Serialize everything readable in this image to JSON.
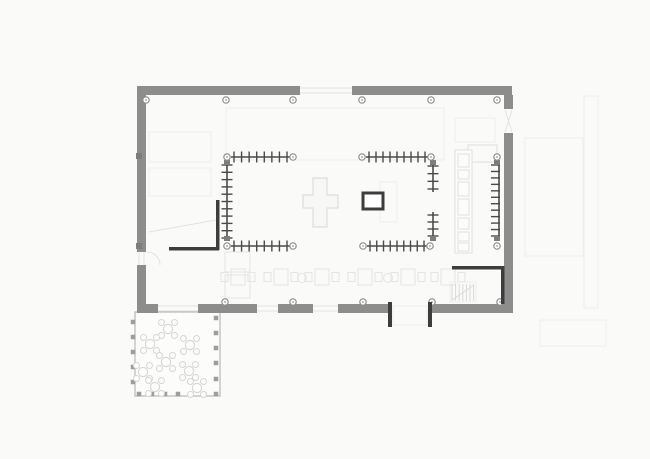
{
  "canvas": {
    "width": 650,
    "height": 459
  },
  "colors": {
    "background": "#fafaf9",
    "wall": "#8d8d8d",
    "wall_dark": "#3d3d3d",
    "table_line": "#4a4a4a",
    "column_stroke": "#8e8e8e",
    "column_fill": "#fdfdfd",
    "column_dot": "#9a9a9a",
    "block": "#7d7d7d",
    "ghost": "#eeeeec",
    "ghost_mid": "#e2e2e1",
    "kitchen": "#dfdfde",
    "stairs": "#d9d9d8",
    "terrace_frame": "#b8b8b8",
    "terrace_post": "#9d9d9d",
    "terrace_furniture": "#d6d6d5",
    "dining_faint": "#e4e4e3",
    "cross_stroke": "#dedddc",
    "cross_fill": "#f7f7f6",
    "stove_stroke": "#3d3d3d",
    "stove_fill": "#ffffff"
  },
  "plan": {
    "walls_outer": [
      [
        137,
        86,
        163,
        9
      ],
      [
        352,
        86,
        160,
        9
      ],
      [
        504,
        95,
        9,
        14
      ],
      [
        504,
        133,
        9,
        180
      ],
      [
        137,
        86,
        9,
        166
      ],
      [
        137,
        265,
        9,
        48
      ],
      [
        146,
        304,
        12,
        9
      ],
      [
        198,
        304,
        59,
        9
      ],
      [
        278,
        304,
        35,
        9
      ],
      [
        338,
        304,
        50,
        9
      ],
      [
        432,
        304,
        81,
        9
      ]
    ],
    "walls_dark": [
      [
        216,
        200,
        3.5,
        50
      ],
      [
        169,
        247,
        50,
        3.5
      ],
      [
        452,
        266,
        52,
        3.5
      ],
      [
        501,
        266,
        3.5,
        38
      ],
      [
        388,
        302,
        4,
        25
      ],
      [
        428,
        302,
        4,
        25
      ]
    ],
    "columns": {
      "radius": 3.2,
      "points": [
        [
          146,
          100
        ],
        [
          226,
          100
        ],
        [
          293,
          100
        ],
        [
          362,
          100
        ],
        [
          431,
          100
        ],
        [
          497,
          100
        ],
        [
          227,
          157
        ],
        [
          293,
          157
        ],
        [
          362,
          157
        ],
        [
          431,
          157
        ],
        [
          497,
          157
        ],
        [
          227,
          246
        ],
        [
          293,
          246
        ],
        [
          363,
          246
        ],
        [
          430,
          246
        ],
        [
          497,
          246
        ],
        [
          225,
          302
        ],
        [
          293,
          302
        ],
        [
          363,
          302
        ],
        [
          432,
          302
        ],
        [
          500,
          302
        ]
      ]
    },
    "blocks": [
      [
        136,
        153,
        6,
        6
      ],
      [
        136,
        243,
        6,
        6
      ],
      [
        224,
        160,
        6,
        5
      ],
      [
        224,
        236,
        6,
        5
      ],
      [
        430,
        160,
        6,
        5
      ],
      [
        430,
        236,
        6,
        5
      ],
      [
        494,
        160,
        6,
        5
      ],
      [
        494,
        236,
        6,
        5
      ]
    ],
    "long_tables": [
      {
        "o": "h",
        "x": 231,
        "y": 157,
        "len": 59,
        "ticks": 8,
        "side": "both"
      },
      {
        "o": "h",
        "x": 366,
        "y": 157,
        "len": 62,
        "ticks": 9,
        "side": "both"
      },
      {
        "o": "h",
        "x": 231,
        "y": 246,
        "len": 59,
        "ticks": 8,
        "side": "both"
      },
      {
        "o": "h",
        "x": 367,
        "y": 246,
        "len": 60,
        "ticks": 9,
        "side": "both"
      },
      {
        "o": "v",
        "x": 227,
        "y": 162,
        "len": 79,
        "ticks": 11,
        "side": "both"
      },
      {
        "o": "v",
        "x": 433,
        "y": 163,
        "len": 29,
        "ticks": 4,
        "side": "both"
      },
      {
        "o": "v",
        "x": 433,
        "y": 212,
        "len": 27,
        "ticks": 4,
        "side": "both"
      },
      {
        "o": "v",
        "x": 499,
        "y": 162,
        "len": 77,
        "ticks": 12,
        "side": "left"
      }
    ],
    "cross_path": "M313 178 H327 V195 H338 V208 H327 V227 H313 V208 H303 V195 H313 Z",
    "stove": [
      363,
      193,
      20,
      16
    ],
    "kitchen": {
      "counter": [
        455,
        150,
        17,
        103
      ],
      "top_strip": [
        468,
        145,
        29,
        17
      ],
      "items": [
        [
          458,
          154,
          11,
          13
        ],
        [
          458,
          170,
          11,
          9
        ],
        [
          458,
          182,
          11,
          14
        ],
        [
          458,
          199,
          11,
          16
        ],
        [
          458,
          218,
          11,
          11
        ],
        [
          458,
          232,
          11,
          9
        ],
        [
          458,
          243,
          11,
          8
        ]
      ]
    },
    "stairs": {
      "x0": 452,
      "treads": 7,
      "step": 3.6,
      "y1": 284,
      "y2": 301,
      "diag": [
        452,
        300,
        474,
        285
      ],
      "box": [
        450,
        282,
        26,
        20
      ]
    },
    "vestibule": [
      393,
      306,
      34,
      19
    ],
    "terrace": {
      "frame": [
        135,
        312,
        85,
        84
      ],
      "posts": [
        [
          133,
          322
        ],
        [
          133,
          337
        ],
        [
          133,
          352
        ],
        [
          133,
          367
        ],
        [
          133,
          382
        ],
        [
          139,
          394
        ],
        [
          152,
          394
        ],
        [
          165,
          394
        ],
        [
          178,
          394
        ],
        [
          191,
          394
        ],
        [
          204,
          394
        ],
        [
          216,
          394
        ],
        [
          216,
          318
        ],
        [
          216,
          333
        ],
        [
          216,
          348
        ],
        [
          216,
          363
        ],
        [
          216,
          379
        ]
      ],
      "post_size": 4.5,
      "tables": [
        [
          168,
          329
        ],
        [
          190,
          345
        ],
        [
          150,
          344
        ],
        [
          166,
          362
        ],
        [
          143,
          372
        ],
        [
          189,
          371
        ],
        [
          155,
          387
        ],
        [
          197,
          388
        ]
      ],
      "table_radius": 4.6,
      "chair_radius": 3,
      "chair_offsets": [
        [
          -6.5,
          -6.5
        ],
        [
          6.5,
          -6.5
        ],
        [
          -6.5,
          6.5
        ],
        [
          6.5,
          6.5
        ]
      ]
    },
    "dining_sets": {
      "centers_x": [
        238,
        281,
        322,
        365,
        408,
        448
      ],
      "cy": 277
    },
    "plants": [
      [
        302,
        278
      ],
      [
        388,
        278
      ]
    ],
    "lounge_rects": [
      [
        225,
        252,
        25,
        20
      ],
      [
        225,
        275,
        25,
        23
      ]
    ],
    "ghost_rects": [
      [
        226,
        108,
        218,
        52
      ],
      [
        149,
        132,
        62,
        30
      ],
      [
        149,
        168,
        62,
        28
      ],
      [
        380,
        182,
        17,
        40
      ],
      [
        525,
        138,
        58,
        118
      ],
      [
        584,
        96,
        14,
        212
      ],
      [
        540,
        320,
        66,
        26
      ],
      [
        455,
        118,
        40,
        24
      ]
    ],
    "ghost_lines": [
      [
        300,
        88,
        352,
        88
      ],
      [
        300,
        93,
        352,
        93
      ],
      [
        139,
        252,
        139,
        265
      ],
      [
        144,
        252,
        144,
        265
      ],
      [
        158,
        306,
        198,
        306
      ],
      [
        158,
        311,
        198,
        311
      ],
      [
        257,
        306,
        278,
        306
      ],
      [
        257,
        311,
        278,
        311
      ],
      [
        313,
        306,
        338,
        306
      ],
      [
        313,
        311,
        338,
        311
      ],
      [
        149,
        232,
        216,
        220
      ],
      [
        505,
        110,
        512,
        132
      ],
      [
        512,
        110,
        505,
        132
      ]
    ],
    "ghost_arcs": [
      "M147 252 a13 13 0 0 1 13 13",
      "M161 312 a19 19 0 0 1 19 19",
      "M197 313 a19 19 0 0 0 -19 18"
    ]
  }
}
